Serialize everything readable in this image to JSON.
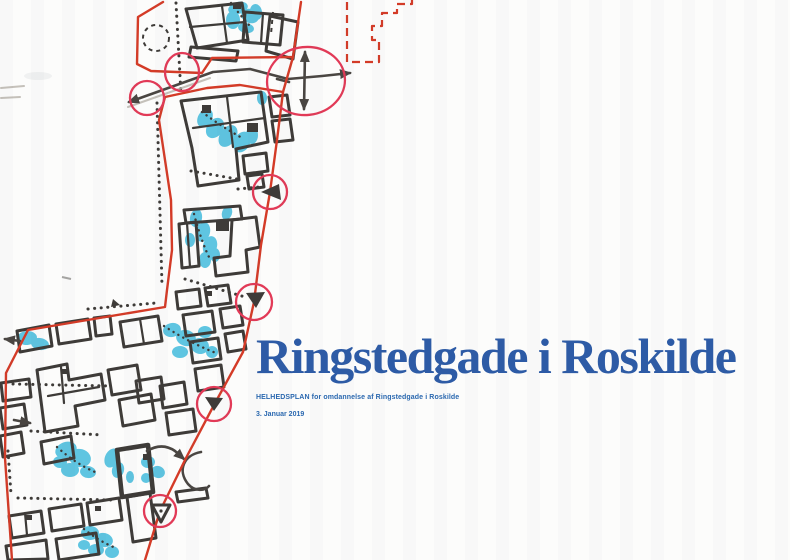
{
  "page": {
    "title": "Ringstedgade i Roskilde",
    "subtitle": "HELHEDSPLAN for omdannelse af Ringstedgade i Roskilde",
    "date": "3. Januar 2019"
  },
  "colors": {
    "title_blue": "#2d5ba6",
    "subtitle_blue": "#2a68b0",
    "map_red": "#d43b27",
    "marker_crimson": "#e23a57",
    "ink": "#3e3b38",
    "tree_cyan": "#31b5da",
    "paper": "#fcfcfb"
  },
  "map": {
    "symbols": {
      "planning_boundary": "red-solid-outline",
      "proposed_area": "red-dashed-outline",
      "focus_node": "crimson-circle",
      "gateway_marker": "black-triangle",
      "tree_highlight": "cyan-marker-blob",
      "movement": "black-double-arrow",
      "path": "black-dotted-line"
    }
  }
}
